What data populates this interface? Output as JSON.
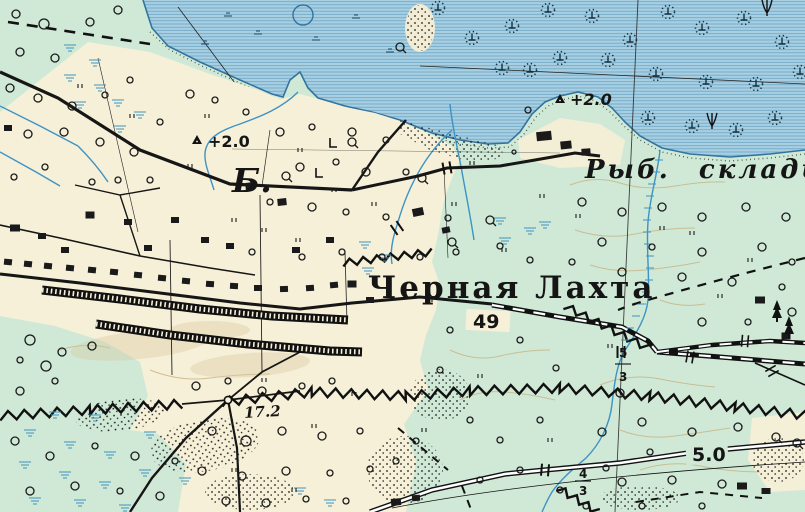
{
  "map": {
    "labels": {
      "settlement": "Черная Лахта",
      "fish_warehouses": "Рыб. склады",
      "letter_b": "Б.",
      "benchmark_field": "+2.0",
      "benchmark_shore": "+2.0",
      "road_number_49": "49",
      "spot_height_17_2": "17.2",
      "road_number_5_0": "5.0",
      "bridge_fraction_south": {
        "numerator": "4",
        "denominator": "3"
      },
      "bridge_fraction_east": {
        "numerator": "5",
        "denominator": "3"
      }
    },
    "colors": {
      "water": "#a9cfe2",
      "water_line": "#69a5c6",
      "shore": "#33749f",
      "land_green": "#cfe9d6",
      "land_cream": "#f6f0d8",
      "stream": "#3d93c4",
      "marsh": "#3f93c0",
      "contour": "#c8b384",
      "ink": "#1a1a1a"
    },
    "features": {
      "trees": [
        [
          16,
          14,
          4
        ],
        [
          44,
          24,
          5
        ],
        [
          20,
          52,
          4
        ],
        [
          55,
          58,
          4
        ],
        [
          90,
          22,
          4
        ],
        [
          118,
          10,
          4
        ],
        [
          10,
          88,
          4
        ],
        [
          38,
          98,
          4
        ],
        [
          72,
          106,
          4
        ],
        [
          105,
          95,
          3
        ],
        [
          130,
          80,
          3
        ],
        [
          28,
          134,
          4
        ],
        [
          64,
          132,
          4
        ],
        [
          100,
          142,
          4
        ],
        [
          134,
          152,
          4
        ],
        [
          160,
          122,
          3
        ],
        [
          190,
          94,
          4
        ],
        [
          215,
          100,
          3
        ],
        [
          246,
          112,
          3
        ],
        [
          150,
          180,
          3
        ],
        [
          118,
          180,
          3
        ],
        [
          92,
          182,
          3
        ],
        [
          45,
          167,
          3
        ],
        [
          14,
          177,
          3
        ],
        [
          280,
          132,
          4
        ],
        [
          312,
          127,
          3
        ],
        [
          352,
          132,
          4
        ],
        [
          386,
          140,
          3
        ],
        [
          300,
          167,
          4
        ],
        [
          336,
          162,
          3
        ],
        [
          366,
          172,
          4
        ],
        [
          406,
          172,
          3
        ],
        [
          270,
          202,
          3
        ],
        [
          312,
          207,
          4
        ],
        [
          346,
          212,
          3
        ],
        [
          386,
          217,
          3
        ],
        [
          448,
          218,
          3
        ],
        [
          252,
          252,
          3
        ],
        [
          302,
          257,
          3
        ],
        [
          342,
          252,
          3
        ],
        [
          382,
          257,
          3
        ],
        [
          420,
          257,
          3
        ],
        [
          456,
          252,
          3
        ],
        [
          582,
          202,
          4
        ],
        [
          622,
          212,
          4
        ],
        [
          662,
          207,
          4
        ],
        [
          702,
          217,
          4
        ],
        [
          746,
          207,
          4
        ],
        [
          786,
          217,
          4
        ],
        [
          602,
          242,
          4
        ],
        [
          652,
          247,
          3
        ],
        [
          702,
          252,
          4
        ],
        [
          762,
          247,
          4
        ],
        [
          792,
          262,
          3
        ],
        [
          572,
          262,
          3
        ],
        [
          622,
          272,
          4
        ],
        [
          682,
          277,
          4
        ],
        [
          732,
          282,
          4
        ],
        [
          782,
          287,
          3
        ],
        [
          702,
          322,
          4
        ],
        [
          748,
          322,
          3
        ],
        [
          792,
          312,
          4
        ],
        [
          602,
          432,
          4
        ],
        [
          642,
          422,
          4
        ],
        [
          692,
          432,
          4
        ],
        [
          738,
          427,
          4
        ],
        [
          650,
          452,
          3
        ],
        [
          606,
          468,
          3
        ],
        [
          622,
          482,
          4
        ],
        [
          672,
          480,
          4
        ],
        [
          722,
          484,
          4
        ],
        [
          586,
          506,
          3
        ],
        [
          642,
          506,
          3
        ],
        [
          702,
          506,
          3
        ],
        [
          196,
          386,
          4
        ],
        [
          228,
          381,
          3
        ],
        [
          262,
          391,
          4
        ],
        [
          302,
          386,
          3
        ],
        [
          332,
          381,
          3
        ],
        [
          212,
          431,
          4
        ],
        [
          246,
          441,
          5
        ],
        [
          282,
          431,
          4
        ],
        [
          322,
          436,
          4
        ],
        [
          360,
          431,
          3
        ],
        [
          202,
          471,
          4
        ],
        [
          242,
          476,
          4
        ],
        [
          286,
          471,
          4
        ],
        [
          330,
          473,
          3
        ],
        [
          370,
          469,
          3
        ],
        [
          226,
          501,
          4
        ],
        [
          266,
          503,
          4
        ],
        [
          306,
          499,
          3
        ],
        [
          346,
          501,
          3
        ],
        [
          396,
          461,
          3
        ],
        [
          416,
          441,
          3
        ],
        [
          20,
          391,
          4
        ],
        [
          55,
          381,
          3
        ],
        [
          15,
          441,
          4
        ],
        [
          50,
          456,
          4
        ],
        [
          95,
          446,
          3
        ],
        [
          135,
          456,
          4
        ],
        [
          175,
          461,
          3
        ],
        [
          30,
          491,
          4
        ],
        [
          75,
          486,
          4
        ],
        [
          120,
          491,
          3
        ],
        [
          160,
          496,
          4
        ],
        [
          30,
          340,
          5
        ],
        [
          62,
          352,
          4
        ],
        [
          92,
          346,
          4
        ],
        [
          46,
          366,
          5
        ],
        [
          20,
          360,
          3
        ],
        [
          528,
          110,
          3
        ],
        [
          514,
          152,
          2
        ],
        [
          500,
          246,
          3
        ],
        [
          530,
          260,
          3
        ],
        [
          480,
          320,
          3
        ],
        [
          520,
          340,
          3
        ],
        [
          556,
          368,
          3
        ],
        [
          470,
          420,
          3
        ],
        [
          500,
          440,
          3
        ],
        [
          540,
          420,
          3
        ],
        [
          480,
          480,
          3
        ],
        [
          520,
          470,
          3
        ],
        [
          560,
          490,
          3
        ],
        [
          440,
          370,
          3
        ],
        [
          450,
          330,
          3
        ]
      ],
      "qtrees": [
        [
          400,
          47
        ],
        [
          286,
          176
        ],
        [
          422,
          178
        ],
        [
          452,
          242
        ],
        [
          620,
          393
        ],
        [
          490,
          220
        ],
        [
          776,
          437
        ],
        [
          797,
          443
        ],
        [
          352,
          142
        ]
      ],
      "buildings": [
        [
          8,
          262,
          8,
          6,
          6
        ],
        [
          28,
          264,
          8,
          6,
          6
        ],
        [
          48,
          266,
          8,
          6,
          6
        ],
        [
          70,
          268,
          8,
          6,
          6
        ],
        [
          92,
          270,
          8,
          6,
          6
        ],
        [
          114,
          272,
          8,
          6,
          6
        ],
        [
          138,
          275,
          8,
          6,
          6
        ],
        [
          162,
          278,
          8,
          6,
          5
        ],
        [
          186,
          281,
          8,
          6,
          5
        ],
        [
          210,
          284,
          8,
          6,
          4
        ],
        [
          234,
          286,
          8,
          6,
          3
        ],
        [
          258,
          288,
          8,
          6,
          0
        ],
        [
          284,
          289,
          8,
          6,
          -2
        ],
        [
          310,
          288,
          8,
          6,
          -4
        ],
        [
          334,
          285,
          8,
          6,
          -5
        ],
        [
          15,
          228,
          10,
          7,
          0
        ],
        [
          42,
          236,
          8,
          6,
          0
        ],
        [
          90,
          215,
          9,
          7,
          0
        ],
        [
          128,
          222,
          8,
          6,
          0
        ],
        [
          148,
          248,
          8,
          6,
          0
        ],
        [
          250,
          186,
          9,
          7,
          -6
        ],
        [
          282,
          202,
          9,
          7,
          -6
        ],
        [
          230,
          246,
          8,
          6,
          0
        ],
        [
          296,
          250,
          8,
          6,
          0
        ],
        [
          418,
          212,
          11,
          8,
          -12
        ],
        [
          446,
          230,
          8,
          6,
          -12
        ],
        [
          352,
          284,
          9,
          7,
          0
        ],
        [
          330,
          240,
          8,
          6,
          0
        ],
        [
          205,
          240,
          8,
          6,
          0
        ],
        [
          175,
          220,
          8,
          6,
          0
        ],
        [
          65,
          250,
          8,
          6,
          0
        ],
        [
          8,
          128,
          8,
          6,
          0
        ],
        [
          370,
          300,
          8,
          6,
          0
        ],
        [
          544,
          136,
          15,
          9,
          -6
        ],
        [
          566,
          145,
          11,
          8,
          -6
        ],
        [
          586,
          152,
          9,
          7,
          -4
        ],
        [
          760,
          300,
          10,
          7,
          0
        ],
        [
          786,
          336,
          9,
          7,
          0
        ],
        [
          396,
          502,
          10,
          7,
          -5
        ],
        [
          416,
          498,
          8,
          6,
          -5
        ],
        [
          742,
          486,
          10,
          7,
          0
        ],
        [
          766,
          491,
          9,
          6,
          0
        ]
      ],
      "grass": [
        [
          78,
          88
        ],
        [
          130,
          118
        ],
        [
          205,
          118
        ],
        [
          188,
          168
        ],
        [
          232,
          222
        ],
        [
          262,
          232
        ],
        [
          298,
          152
        ],
        [
          332,
          192
        ],
        [
          372,
          206
        ],
        [
          296,
          242
        ],
        [
          452,
          206
        ],
        [
          428,
          302
        ],
        [
          262,
          382
        ],
        [
          312,
          428
        ],
        [
          352,
          396
        ],
        [
          422,
          432
        ],
        [
          478,
          378
        ],
        [
          502,
          252
        ],
        [
          548,
          442
        ],
        [
          232,
          472
        ],
        [
          292,
          492
        ],
        [
          576,
          218
        ],
        [
          690,
          235
        ],
        [
          748,
          262
        ],
        [
          718,
          298
        ],
        [
          608,
          348
        ],
        [
          660,
          230
        ],
        [
          540,
          198
        ],
        [
          470,
          165
        ]
      ],
      "marsh_land": [
        [
          70,
          45
        ],
        [
          95,
          60
        ],
        [
          70,
          75
        ],
        [
          100,
          85
        ],
        [
          80,
          102
        ],
        [
          118,
          100
        ],
        [
          140,
          112
        ],
        [
          120,
          126
        ],
        [
          365,
          242
        ],
        [
          385,
          255
        ],
        [
          368,
          268
        ],
        [
          500,
          218
        ],
        [
          530,
          228
        ],
        [
          505,
          238
        ],
        [
          545,
          222
        ],
        [
          30,
          430
        ],
        [
          70,
          442
        ],
        [
          110,
          452
        ],
        [
          25,
          462
        ],
        [
          65,
          472
        ],
        [
          105,
          482
        ],
        [
          145,
          470
        ],
        [
          35,
          498
        ],
        [
          80,
          500
        ],
        [
          150,
          432
        ],
        [
          185,
          478
        ],
        [
          125,
          505
        ],
        [
          300,
          488
        ],
        [
          330,
          500
        ],
        [
          55,
          412
        ],
        [
          95,
          415
        ]
      ],
      "marsh_water": [
        [
          228,
          16
        ],
        [
          258,
          34
        ],
        [
          316,
          40
        ],
        [
          356,
          18
        ],
        [
          390,
          52
        ],
        [
          205,
          44
        ]
      ],
      "reeds": [
        [
          438,
          8
        ],
        [
          472,
          38
        ],
        [
          512,
          26
        ],
        [
          548,
          10
        ],
        [
          592,
          16
        ],
        [
          630,
          40
        ],
        [
          668,
          12
        ],
        [
          702,
          28
        ],
        [
          744,
          18
        ],
        [
          782,
          42
        ],
        [
          800,
          72
        ],
        [
          756,
          84
        ],
        [
          706,
          82
        ],
        [
          656,
          74
        ],
        [
          608,
          60
        ],
        [
          560,
          58
        ],
        [
          502,
          68
        ],
        [
          530,
          70
        ],
        [
          648,
          118
        ],
        [
          692,
          126
        ],
        [
          736,
          130
        ],
        [
          775,
          118
        ]
      ],
      "tridents": [
        [
          712,
          126
        ],
        [
          767,
          13
        ]
      ],
      "stream_ticks": [
        [
          659,
          160
        ],
        [
          656,
          172
        ],
        [
          652,
          184
        ],
        [
          650,
          196
        ],
        [
          648,
          208
        ],
        [
          647,
          220
        ],
        [
          647,
          232
        ],
        [
          648,
          244
        ],
        [
          650,
          256
        ],
        [
          650,
          268
        ],
        [
          649,
          280
        ],
        [
          646,
          292
        ],
        [
          642,
          304
        ],
        [
          636,
          316
        ],
        [
          630,
          328
        ],
        [
          625,
          340
        ]
      ],
      "gates": [
        [
          690,
          357,
          10
        ],
        [
          745,
          341,
          5
        ],
        [
          772,
          371,
          60
        ]
      ],
      "bridges": [
        [
          447,
          168,
          80
        ],
        [
          397,
          228,
          55
        ],
        [
          545,
          470,
          95
        ],
        [
          621,
          352,
          90
        ]
      ],
      "benchmarks": [
        [
          197,
          140
        ],
        [
          560,
          99
        ]
      ]
    }
  }
}
